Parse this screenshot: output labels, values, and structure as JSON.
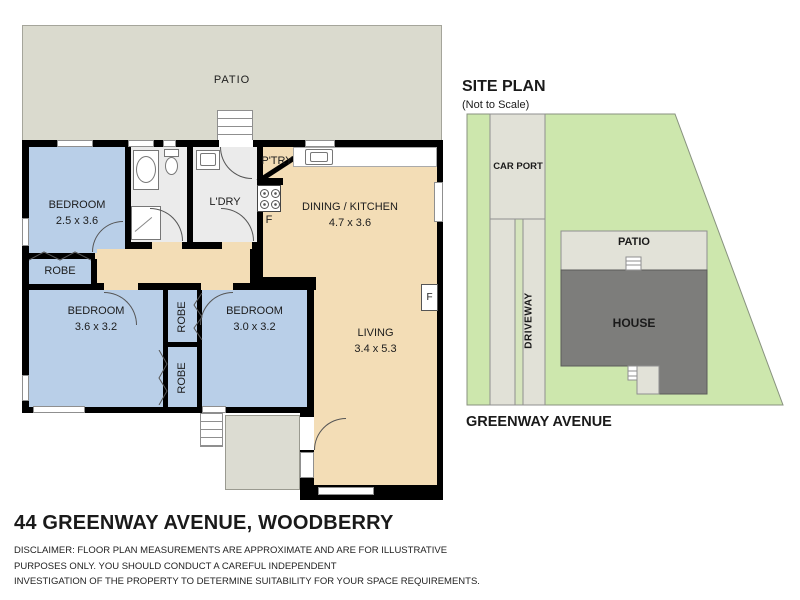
{
  "floor_plan": {
    "patio_label": "PATIO",
    "rooms": {
      "bedroom1": {
        "name": "BEDROOM",
        "dims": "2.5 x 3.6"
      },
      "robe1": {
        "name": "ROBE"
      },
      "laundry": {
        "name": "L'DRY"
      },
      "pantry": {
        "name": "P'TRY"
      },
      "dining_kitchen": {
        "name": "DINING / KITCHEN",
        "dims": "4.7 x 3.6"
      },
      "bedroom2": {
        "name": "BEDROOM",
        "dims": "3.6 x 3.2"
      },
      "robe2": {
        "name": "ROBE"
      },
      "robe3": {
        "name": "ROBE"
      },
      "bedroom3": {
        "name": "BEDROOM",
        "dims": "3.0 x 3.2"
      },
      "living": {
        "name": "LIVING",
        "dims": "3.4 x 5.3"
      }
    },
    "fridge_label": "F",
    "wall_f_label": "F"
  },
  "site_plan": {
    "title": "SITE PLAN",
    "subtitle": "(Not to Scale)",
    "car_port_label": "CAR PORT",
    "driveway_label": "DRIVEWAY",
    "patio_label": "PATIO",
    "house_label": "HOUSE",
    "street_label": "GREENWAY AVENUE"
  },
  "footer": {
    "address": "44 GREENWAY AVENUE, WOODBERRY",
    "disclaimer_line1": "DISCLAIMER: FLOOR PLAN MEASUREMENTS ARE APPROXIMATE AND ARE FOR ILLUSTRATIVE",
    "disclaimer_line2": "PURPOSES ONLY. YOU SHOULD CONDUCT A CAREFUL INDEPENDENT",
    "disclaimer_line3": "INVESTIGATION OF THE PROPERTY TO DETERMINE SUITABILITY FOR YOUR SPACE REQUIREMENTS."
  },
  "colors": {
    "wall": "#000000",
    "bedroom_blue": "#b9cfe8",
    "living_tan": "#f3ddb6",
    "wet_area_gray": "#ebebeb",
    "patio_gray": "#dadace",
    "porch_gray": "#dcdcd2",
    "lot_green": "#cde7ad",
    "paving_gray": "#e1e1d7",
    "house_gray": "#7d7d7b"
  }
}
